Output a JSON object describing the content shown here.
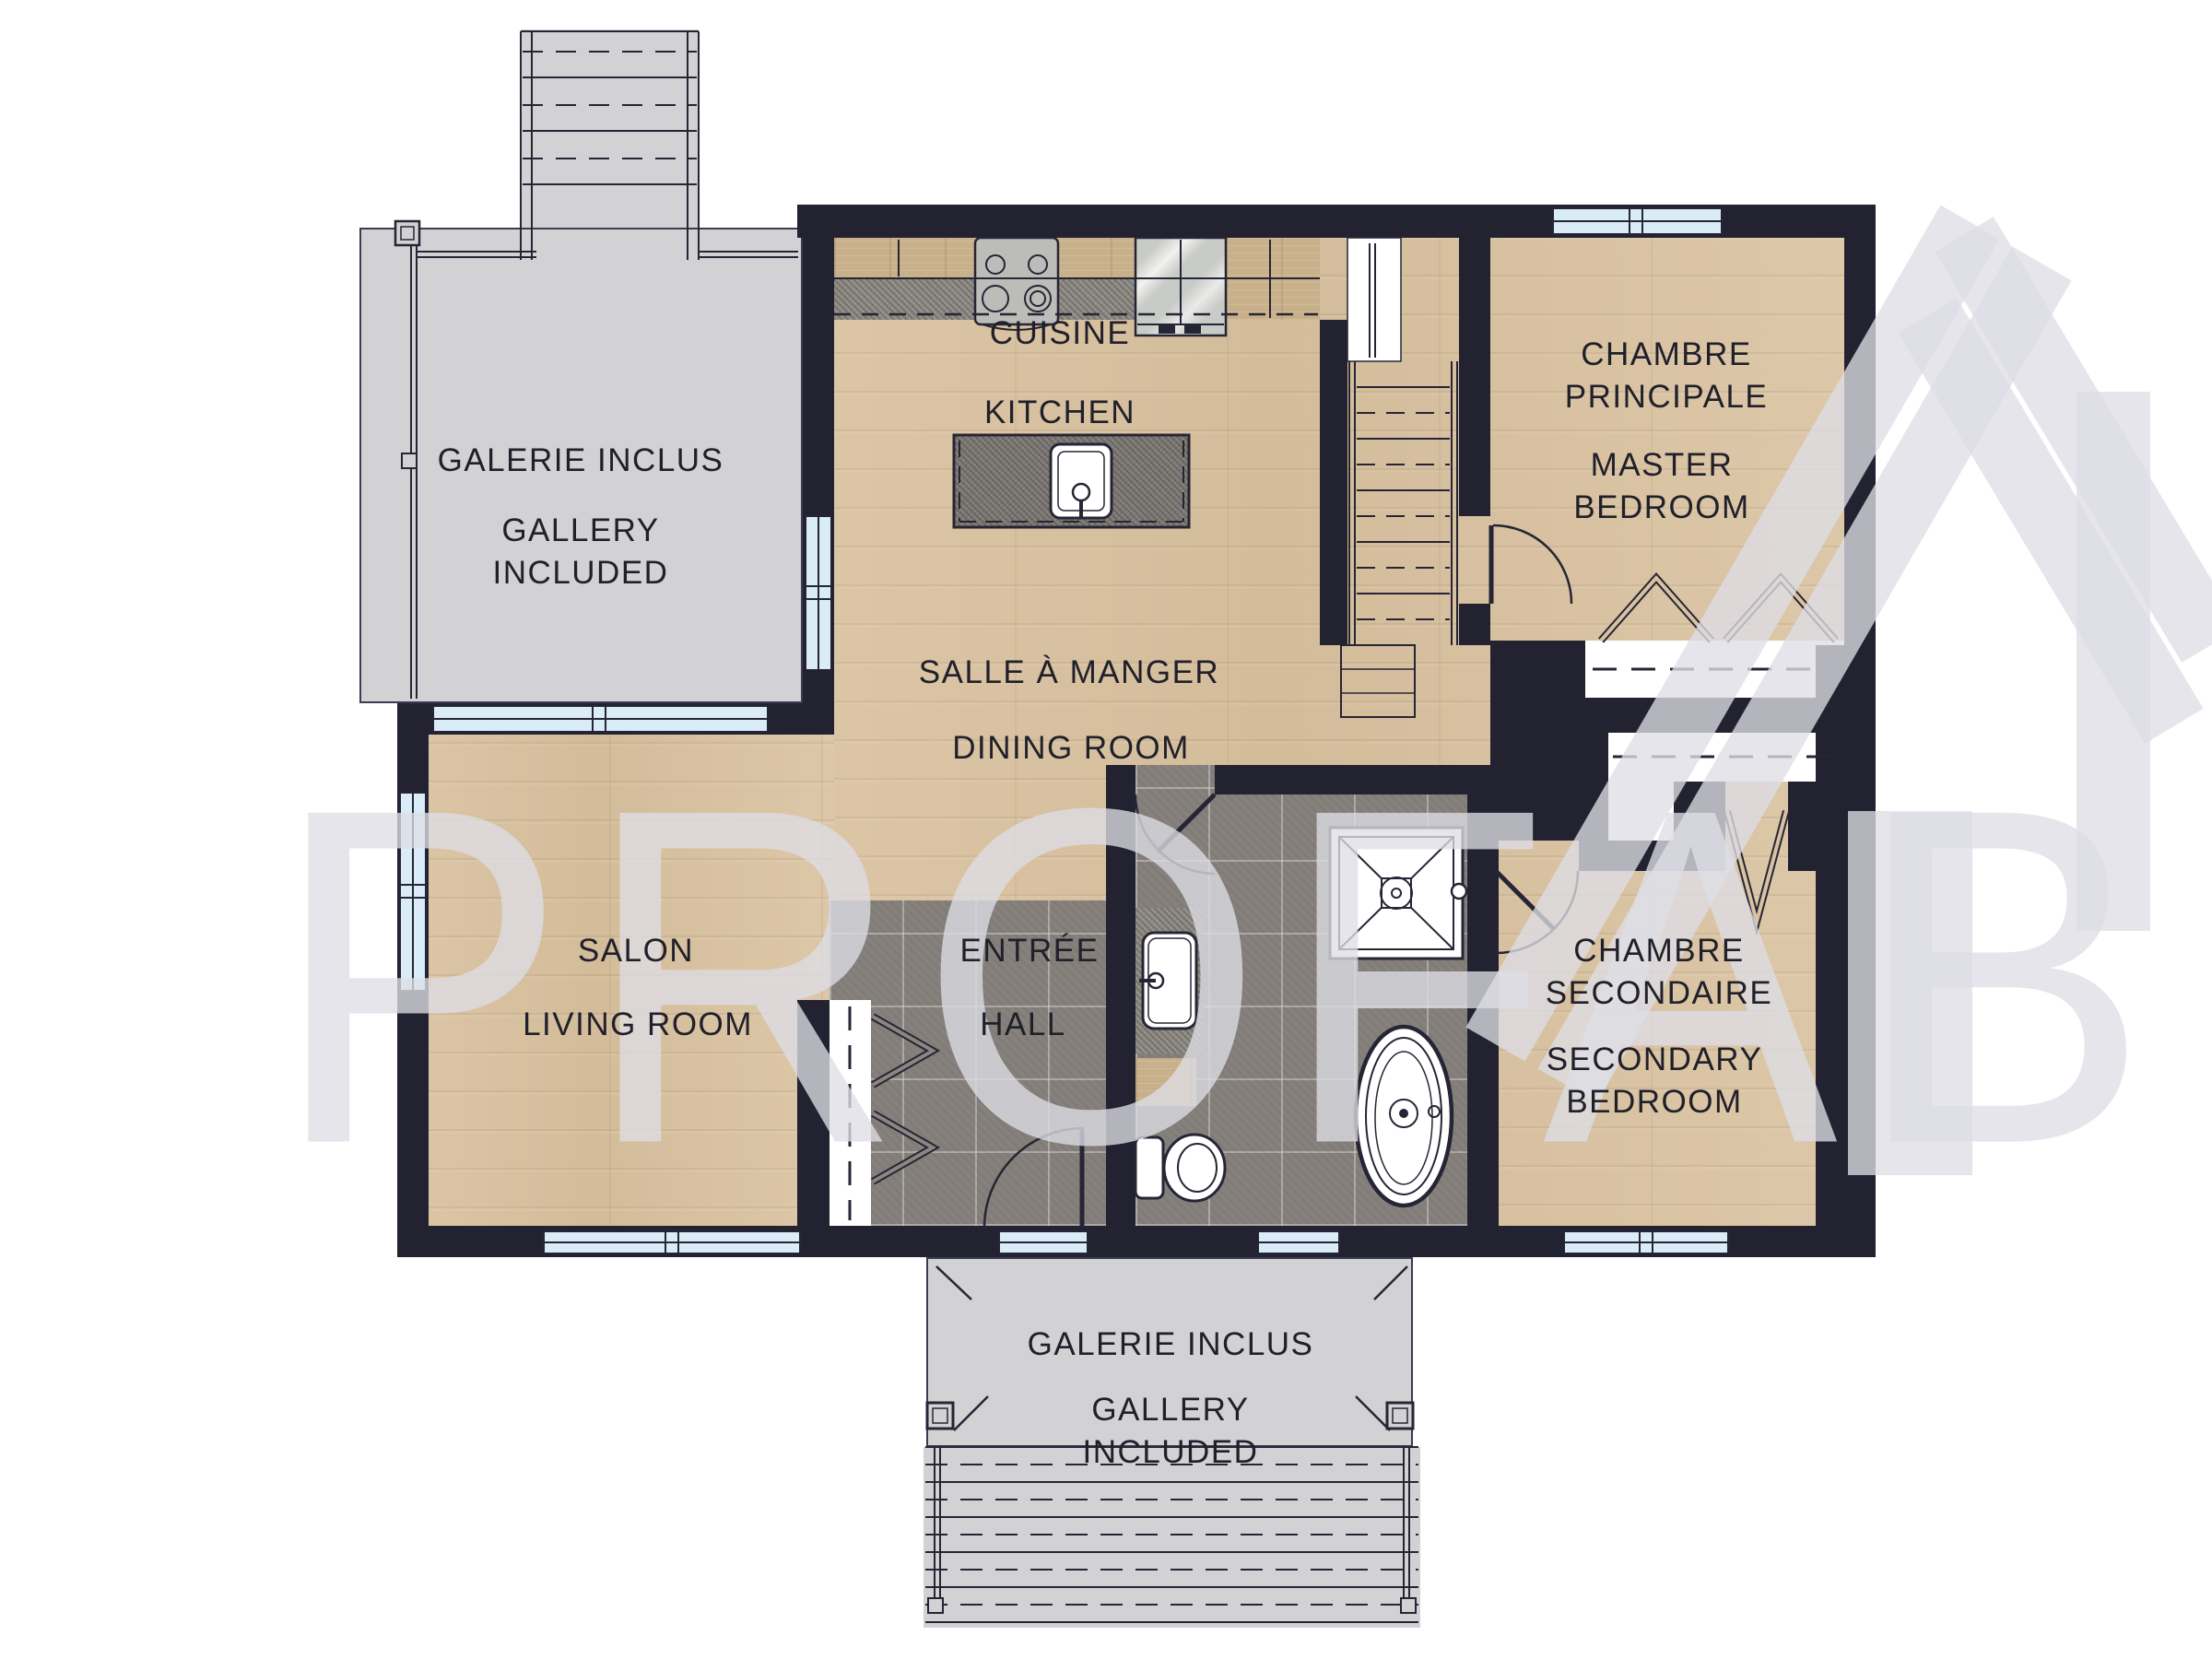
{
  "watermark": {
    "text": "PROFAB"
  },
  "labels": {
    "kitchen_fr": "CUISINE",
    "kitchen_en": "KITCHEN",
    "dining_fr": "SALLE À MANGER",
    "dining_en": "DINING ROOM",
    "living_fr": "SALON",
    "living_en": "LIVING ROOM",
    "hall_fr": "ENTRÉE",
    "hall_en": "HALL",
    "master_fr": "CHAMBRE\nPRINCIPALE",
    "master_en": "MASTER\nBEDROOM",
    "secondary_fr": "CHAMBRE\nSECONDAIRE",
    "secondary_en": "SECONDARY\nBEDROOM",
    "gallery_top_fr": "GALERIE INCLUS",
    "gallery_top_en": "GALLERY\nINCLUDED",
    "gallery_bottom_fr": "GALERIE INCLUS",
    "gallery_bottom_en": "GALLERY\nINCLUDED"
  },
  "colors": {
    "wall": "#232231",
    "wood": "#d8c2a2",
    "tile": "#86817c",
    "deck": "#d2d2d4",
    "glass": "#d9ecf8",
    "counter": "#8f8b85",
    "cabinet": "#c8b08a",
    "label": "#20202a",
    "wm": "rgba(222,222,230,0.78)"
  }
}
